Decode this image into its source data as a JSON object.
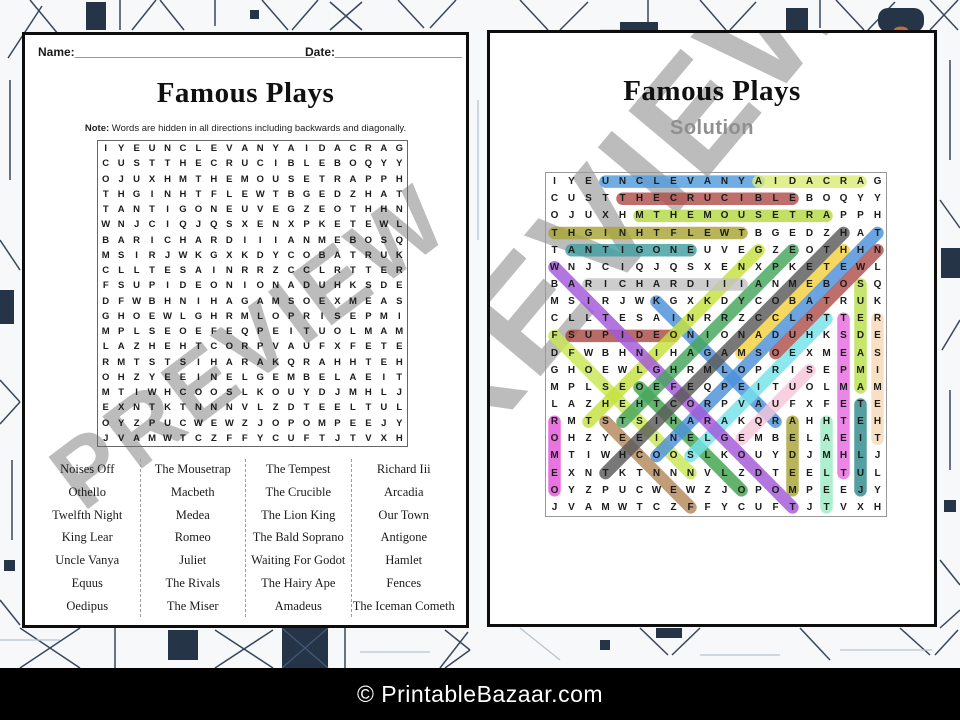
{
  "watermark": "PREVIEW",
  "worksheet": {
    "name_label": "Name:",
    "name_line": "____________________________________",
    "date_label": "Date:",
    "date_line": "___________________",
    "title": "Famous Plays",
    "note_label": "Note:",
    "note_text": "Words are hidden in all directions including backwards and diagonally."
  },
  "solution": {
    "title": "Famous Plays",
    "subtitle": "Solution"
  },
  "footer": {
    "copyright": "© PrintableBazaar.com"
  },
  "grid": {
    "size": 20,
    "rows": [
      "IYEUNCLEVANYAIDACRAG",
      "CUSTTHECRUCIBLEBOQYY",
      "OJUXHMTHEMOUSETRAPPH",
      "THGINHTFLEWTBGEDZHAT",
      "TANTIGONEUVEGZEOTHHN",
      "WNJCIQJQSXENXPKETEWL",
      "BARICHARDIIIANMEBOSQ",
      "MSIRJWKGXKDYCOBATRUK",
      "CLLTESAINRRZCCLRTTER",
      "FSUPIDEONIONADUHKSDE",
      "DFWBHNIHAGAMSOEXMEAS",
      "GHOEWLGHRMLOPRISEPMI",
      "MPLSEOEFEQPEITUOLMAM",
      "LAZHEHTCORPVAUFXFETE",
      "RMTSTSIHARAKQRAHHTEH",
      "OHZYEEINELGEMBELAEIT",
      "MTIWHCOOSLKOUYDJMHLJ",
      "EXNTKTNNNVLZDTEELTUL",
      "OYZPUCWEWZJOPOMPEEJY",
      "JVAMWTCZFFYCUFTJTVXH"
    ]
  },
  "word_list_columns": 4,
  "words": [
    {
      "label": "Noises Off",
      "color": "#c9e654",
      "from": [
        18,
        9
      ],
      "to": [
        10,
        1
      ]
    },
    {
      "label": "Othello",
      "color": "#3fa34d",
      "from": [
        13,
        6
      ],
      "to": [
        19,
        12
      ]
    },
    {
      "label": "Twelfth Night",
      "color": "#a7a336",
      "from": [
        4,
        12
      ],
      "to": [
        4,
        1
      ]
    },
    {
      "label": "King Lear",
      "color": "#4a90d9",
      "from": [
        8,
        7
      ],
      "to": [
        15,
        14
      ]
    },
    {
      "label": "Uncle Vanya",
      "color": "#4f9bdc",
      "from": [
        1,
        4
      ],
      "to": [
        1,
        13
      ]
    },
    {
      "label": "Equus",
      "color": "#f7c6d9",
      "from": [
        16,
        12
      ],
      "to": [
        12,
        16
      ]
    },
    {
      "label": "Oedipus",
      "color": "#a84a45",
      "from": [
        10,
        8
      ],
      "to": [
        10,
        2
      ]
    },
    {
      "label": "The Mousetrap",
      "color": "#b6d944",
      "from": [
        3,
        6
      ],
      "to": [
        3,
        17
      ]
    },
    {
      "label": "Macbeth",
      "color": "#f2d03c",
      "from": [
        11,
        12
      ],
      "to": [
        5,
        18
      ]
    },
    {
      "label": "Medea",
      "color": "#a7a336",
      "from": [
        19,
        15
      ],
      "to": [
        15,
        15
      ]
    },
    {
      "label": "Romeo",
      "color": "#e255d8",
      "from": [
        15,
        1
      ],
      "to": [
        19,
        1
      ]
    },
    {
      "label": "Juliet",
      "color": "#2e8b8b",
      "from": [
        19,
        19
      ],
      "to": [
        14,
        19
      ]
    },
    {
      "label": "The Rivals",
      "color": "#74e3ea",
      "from": [
        9,
        17
      ],
      "to": [
        17,
        9
      ]
    },
    {
      "label": "The Miser",
      "color": "#f6d9b8",
      "from": [
        16,
        20
      ],
      "to": [
        9,
        20
      ]
    },
    {
      "label": "The Tempest",
      "color": "#e86be0",
      "from": [
        18,
        18
      ],
      "to": [
        9,
        18
      ]
    },
    {
      "label": "The Crucible",
      "color": "#b04e4a",
      "from": [
        2,
        5
      ],
      "to": [
        2,
        15
      ]
    },
    {
      "label": "The Lion King",
      "color": "#c4e03c",
      "from": [
        15,
        3
      ],
      "to": [
        5,
        13
      ]
    },
    {
      "label": "The Bald Soprano",
      "color": "#4a90d9",
      "from": [
        4,
        20
      ],
      "to": [
        17,
        7
      ]
    },
    {
      "label": "Waiting For Godot",
      "color": "#a257d8",
      "from": [
        6,
        1
      ],
      "to": [
        20,
        15
      ]
    },
    {
      "label": "The Hairy Ape",
      "color": "#46a65c",
      "from": [
        15,
        5
      ],
      "to": [
        5,
        15
      ]
    },
    {
      "label": "Amadeus",
      "color": "#b9e04a",
      "from": [
        13,
        19
      ],
      "to": [
        7,
        19
      ]
    },
    {
      "label": "Richard Iii",
      "color": "#c2c2c2",
      "from": [
        7,
        3
      ],
      "to": [
        7,
        12
      ]
    },
    {
      "label": "Arcadia",
      "color": "#dcec77",
      "from": [
        1,
        19
      ],
      "to": [
        1,
        13
      ]
    },
    {
      "label": "Our Town",
      "color": "#b04e4a",
      "from": [
        11,
        14
      ],
      "to": [
        5,
        20
      ]
    },
    {
      "label": "Antigone",
      "color": "#3f9fa0",
      "from": [
        5,
        2
      ],
      "to": [
        5,
        9
      ]
    },
    {
      "label": "Hamlet",
      "color": "#9cecc4",
      "from": [
        15,
        17
      ],
      "to": [
        20,
        17
      ]
    },
    {
      "label": "Fences",
      "color": "#b3885a",
      "from": [
        20,
        9
      ],
      "to": [
        15,
        4
      ]
    },
    {
      "label": "The Iceman Cometh",
      "color": "#5a5a5a",
      "from": [
        18,
        4
      ],
      "to": [
        4,
        18
      ]
    }
  ]
}
